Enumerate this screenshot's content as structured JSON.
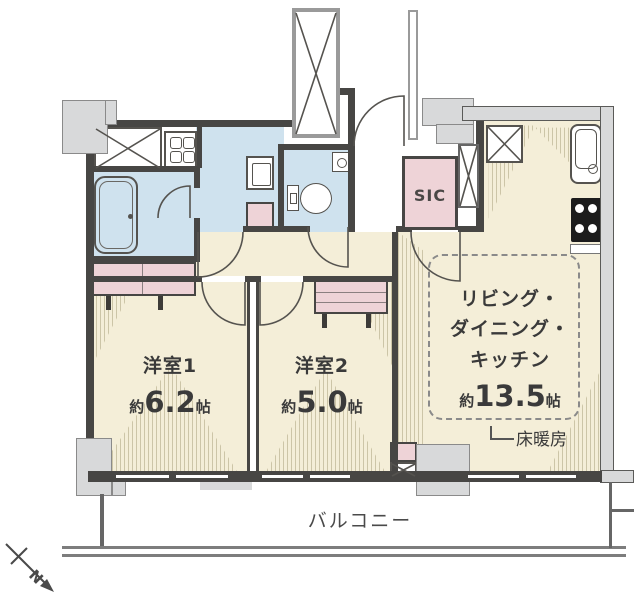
{
  "plan": {
    "rooms": {
      "room1": {
        "name": "洋室1",
        "size_prefix": "約",
        "size_value": "6.2",
        "size_unit": "帖"
      },
      "room2": {
        "name": "洋室2",
        "size_prefix": "約",
        "size_value": "5.0",
        "size_unit": "帖"
      },
      "ldk": {
        "line1": "リビング・",
        "line2": "ダイニング・",
        "line3": "キッチン",
        "size_prefix": "約",
        "size_value": "13.5",
        "size_unit": "帖"
      },
      "sic": {
        "label": "SIC"
      },
      "floor_heating": {
        "label": "床暖房"
      },
      "balcony": {
        "label": "バルコニー"
      }
    },
    "compass": {
      "label": "N"
    },
    "colors": {
      "floor": "#f4eed8",
      "wet": "#cfe2ee",
      "storage": "#eed3d7",
      "wall": "#474644",
      "column": "#d8d9da",
      "line": "#55534f"
    }
  }
}
